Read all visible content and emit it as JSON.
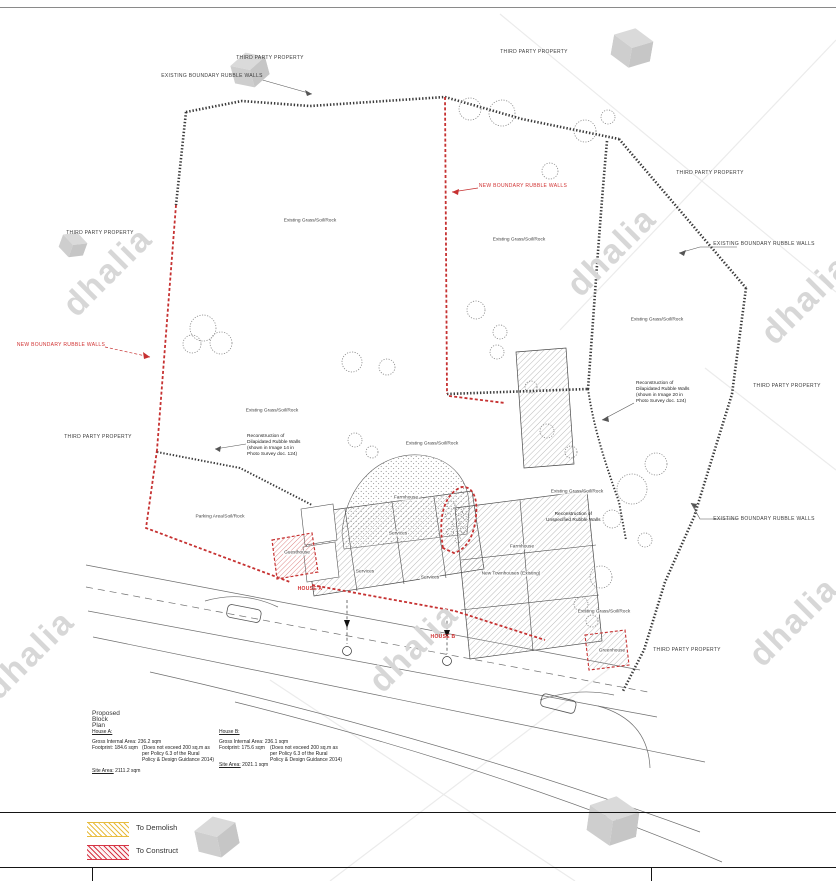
{
  "labels": {
    "third_party_property": "THIRD PARTY PROPERTY",
    "existing_boundary_walls": "EXISTING BOUNDARY RUBBLE WALLS",
    "new_boundary_walls": "NEW BOUNDARY RUBBLE WALLS",
    "existing_grass": "Existing Grass/Soil/Rock",
    "parking_area": "Parking Area/Soil/Rock",
    "farmhouse": "Farmhouse",
    "services": "Services",
    "guesthouse": "Guesthouse",
    "greenhouse": "Greenhouse",
    "new_townhouses": "New Townhouses (Existing)",
    "house_a": "HOUSE A",
    "house_b": "HOUSE B",
    "recon14": {
      "line1": "Reconstruction of",
      "line2": "Dilapidated Rubble Walls",
      "line3": "(shown in Image 14 in",
      "line4": "Photo Survey doc. 124)"
    },
    "recon20": {
      "line1": "Reconstruction of",
      "line2": "Dilapidated Rubble Walls",
      "line3": "(shown in Image 20 in",
      "line4": "Photo Survey doc. 124)"
    },
    "recon_unspecified": {
      "line1": "Reconstruction of",
      "line2": "Unspecified Rubble Walls"
    }
  },
  "summary": {
    "title": "Proposed Block Plan",
    "house_a": {
      "heading": "House A:",
      "gia_label": "Gross Internal Area:",
      "gia_value": "236.2 sqm",
      "footprint_label": "Footprint:",
      "footprint_value": "184.6 sqm",
      "note1": "(Does not exceed 200 sq.m as",
      "note2": "per Policy 6.3 of the Rural",
      "note3": "Policy & Design Guidance 2014)",
      "site_label": "Site Area:",
      "site_value": "2111.2 sqm"
    },
    "house_b": {
      "heading": "House B:",
      "gia_label": "Gross Internal Area:",
      "gia_value": "236.1 sqm",
      "footprint_label": "Footprint:",
      "footprint_value": "175.6 sqm",
      "note1": "(Does not exceed 200 sq.m as",
      "note2": "per Policy 6.3 of the Rural",
      "note3": "Policy & Design Guidance 2014)",
      "site_label": "Site Area:",
      "site_value": "2021.1 sqm"
    }
  },
  "legend": {
    "demolish": "To Demolish",
    "construct": "To Construct"
  },
  "watermark": {
    "text": "dhalia"
  },
  "colors": {
    "wall_black": "#3a3a3a",
    "new_wall_red": "#c63131",
    "label_red": "#d03030",
    "demolish_yellow": "#e8bc3f",
    "construct_red": "#d63545"
  }
}
